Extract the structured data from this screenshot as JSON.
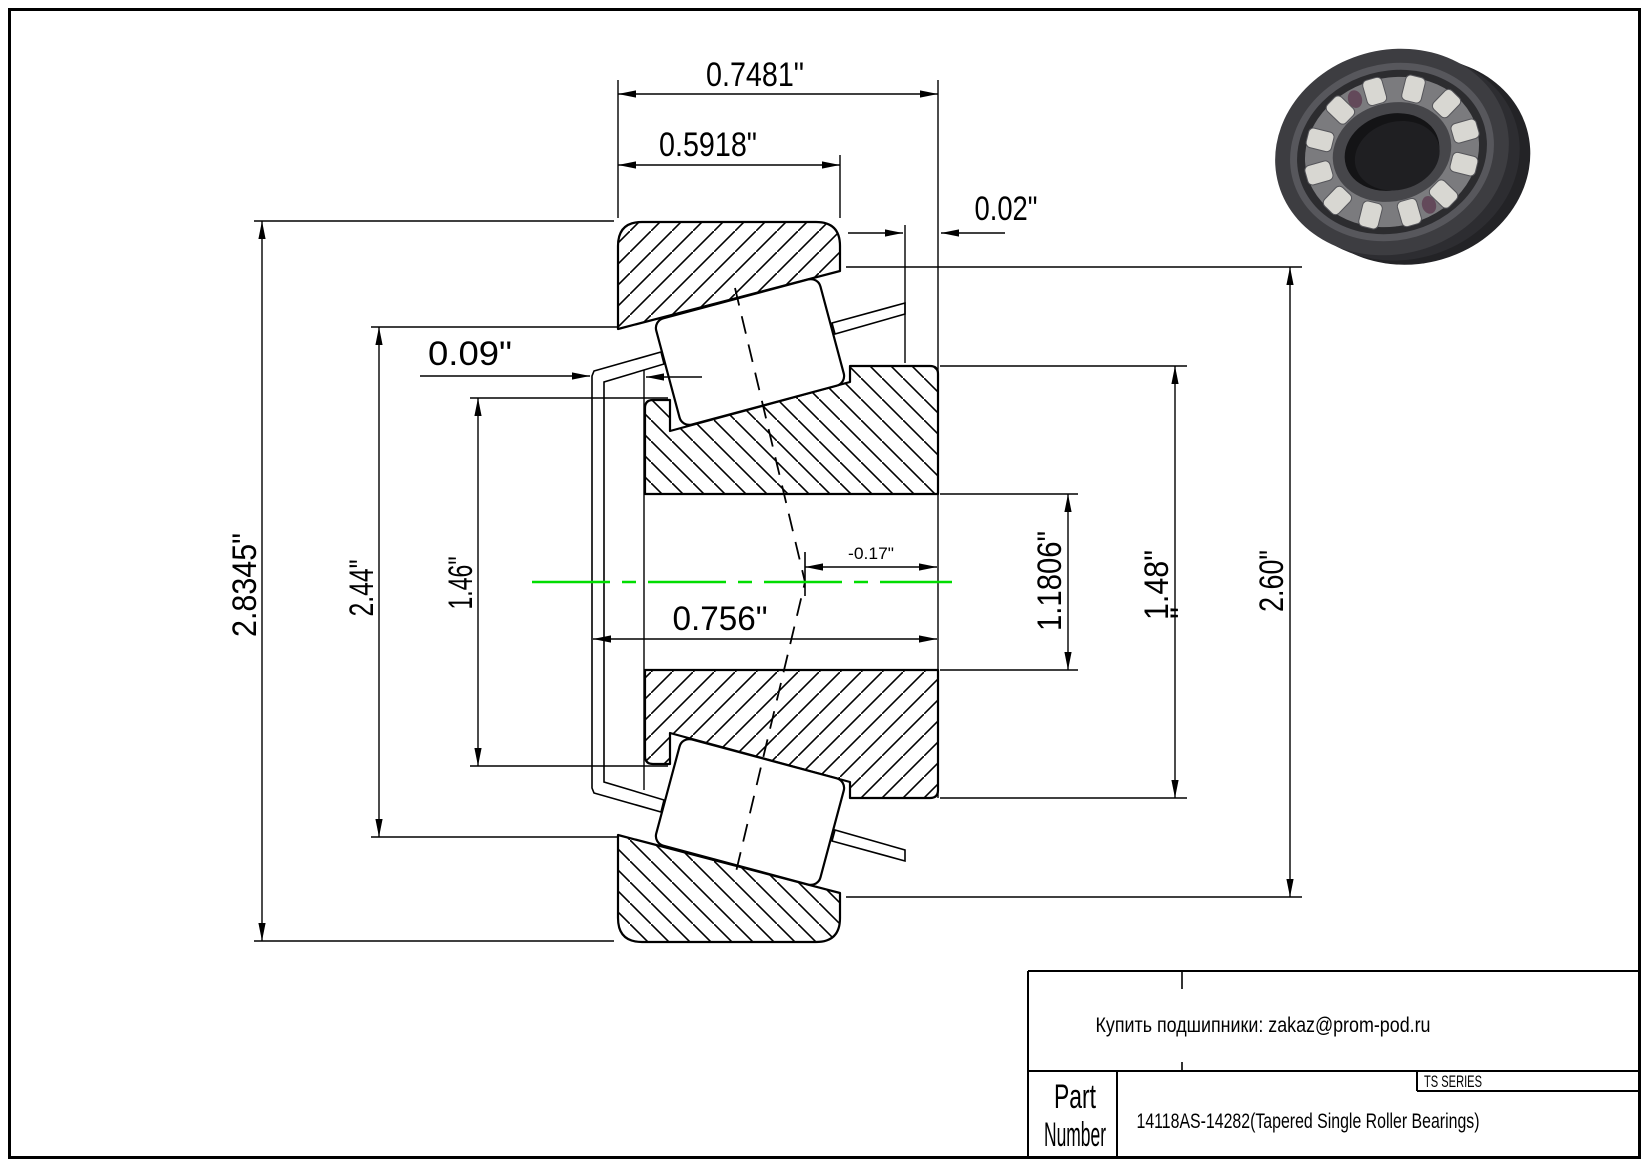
{
  "drawing": {
    "dims": {
      "total_width": "0.7481\"",
      "cup_width": "0.5918\"",
      "cage_clearance": "0.02\"",
      "cage_standout": "0.09\"",
      "cup_od": "2.8345\"",
      "flange_od": "2.44\"",
      "cone_front_od": "1.46\"",
      "cone_width": "0.756\"",
      "effective_center": "-0.17\"",
      "bore_dia": "1.1806\"",
      "rib_dia": "1.48\"",
      "rib_dia_overflow": "\"",
      "cup_id": "2.60\""
    },
    "centerline_color": "#00dd00"
  },
  "title_block": {
    "contact": "Купить подшипники: zakaz@prom-pod.ru",
    "series": "TS SERIES",
    "part_label_line1": "Part",
    "part_label_line2": "Number",
    "part_number": "14118AS-14282(Tapered Single Roller Bearings)"
  }
}
